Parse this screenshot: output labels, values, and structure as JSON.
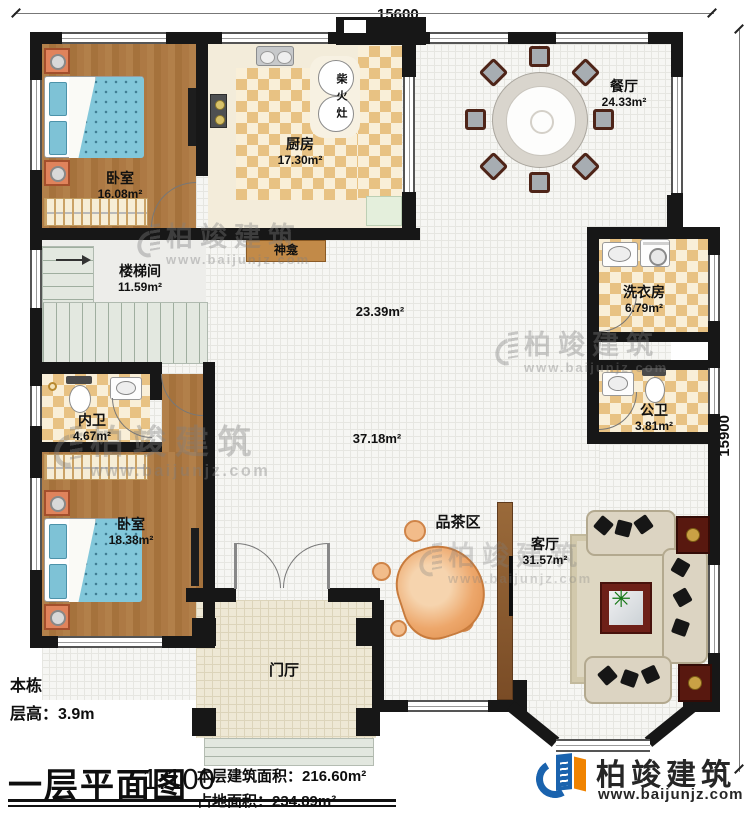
{
  "dimensions": {
    "top": "15600",
    "right": "15900"
  },
  "rooms": {
    "bedroom1": {
      "name": "卧室",
      "area": "16.08m²"
    },
    "kitchen": {
      "name": "厨房",
      "area": "17.30m²"
    },
    "dining": {
      "name": "餐厅",
      "area": "24.33m²"
    },
    "stair": {
      "name": "楼梯间",
      "area": "11.59m²"
    },
    "laundry": {
      "name": "洗衣房",
      "area": "6.79m²"
    },
    "ensuite": {
      "name": "内卫",
      "area": "4.67m²"
    },
    "pubbath": {
      "name": "公卫",
      "area": "3.81m²"
    },
    "bedroom2": {
      "name": "卧室",
      "area": "18.38m²"
    },
    "living": {
      "name": "客厅",
      "area": "31.57m²"
    },
    "tea": {
      "name": "品茶区"
    },
    "foyer": {
      "name": "门厅"
    }
  },
  "open_areas": {
    "hall_upper": "23.39m²",
    "hall_lower": "37.18m²"
  },
  "features": {
    "stove": "柴火灶",
    "shrine": "神龛"
  },
  "watermark": {
    "brand": "柏竣建筑",
    "url": "www.baijunjz.com"
  },
  "footer": {
    "building_area_label": "本栋建筑面积：",
    "building_area": "450.00m²",
    "floor_height_label": "层高：",
    "floor_height": "3.9m",
    "title": "一层平面图",
    "scale": "1:100",
    "floor_area_label": "本层建筑面积：",
    "floor_area": "216.60m²",
    "footprint_label": "占地面积：",
    "footprint": "234.89m²"
  },
  "logo": {
    "brand": "柏竣建筑",
    "url": "www.baijunjz.com"
  }
}
